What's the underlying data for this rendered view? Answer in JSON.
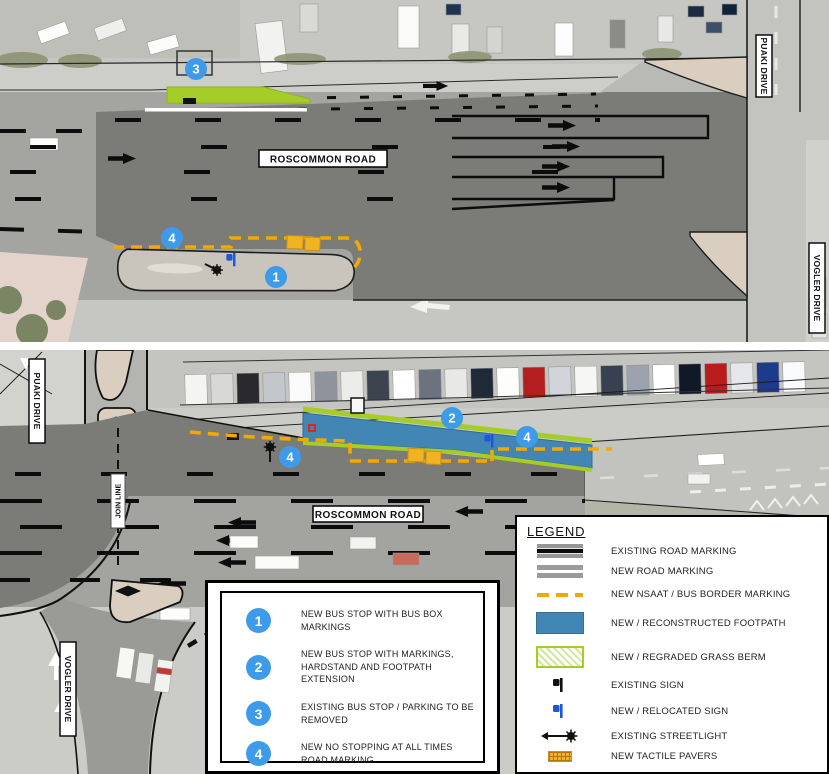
{
  "streets": {
    "roscommon_top": "ROSCOMMON ROAD",
    "roscommon_bottom": "ROSCOMMON ROAD",
    "puaki_top": "PUAKI DRIVE",
    "puaki_bottom": "PUAKI DRIVE",
    "vogler_top": "VOGLER DRIVE",
    "vogler_bottom": "VOGLER DRIVE",
    "join_line": "JOIN LINE"
  },
  "map_markers": {
    "top": [
      "3",
      "4",
      "1"
    ],
    "bottom": [
      "2",
      "4",
      "4"
    ]
  },
  "legend": {
    "title": "LEGEND",
    "items": [
      {
        "key": "existing-road-marking",
        "label": "EXISTING ROAD MARKING"
      },
      {
        "key": "new-road-marking",
        "label": "NEW ROAD MARKING"
      },
      {
        "key": "new-nsaat-bus-border-marking",
        "label": "NEW NSAAT / BUS BORDER MARKING"
      },
      {
        "key": "new-reconstructed-footpath",
        "label": "NEW / RECONSTRUCTED FOOTPATH"
      },
      {
        "key": "new-regraded-grass-berm",
        "label": "NEW / REGRADED GRASS BERM"
      },
      {
        "key": "existing-sign",
        "label": "EXISTING SIGN"
      },
      {
        "key": "new-relocated-sign",
        "label": "NEW / RELOCATED SIGN"
      },
      {
        "key": "existing-streetlight",
        "label": "EXISTING STREETLIGHT"
      },
      {
        "key": "new-tactile-pavers",
        "label": "NEW TACTILE PAVERS"
      }
    ]
  },
  "callouts": [
    {
      "num": "1",
      "text": "NEW BUS STOP WITH BUS BOX MARKINGS"
    },
    {
      "num": "2",
      "text": "NEW BUS STOP WITH MARKINGS, HARDSTAND AND FOOTPATH EXTENSION"
    },
    {
      "num": "3",
      "text": "EXISTING BUS STOP / PARKING TO BE REMOVED"
    },
    {
      "num": "4",
      "text": "NEW NO STOPPING AT ALL TIMES ROAD MARKING"
    }
  ],
  "colors": {
    "marker_blue": "#3D9BE9",
    "nsaat_orange": "#F5A800",
    "footpath_blue": "#4186B4",
    "grass_berm_green": "#A6CC28",
    "tactile_yellow": "#F2B322",
    "new_sign_blue": "#1F57D8",
    "existing_overlay_grey": "#7B7B78"
  }
}
